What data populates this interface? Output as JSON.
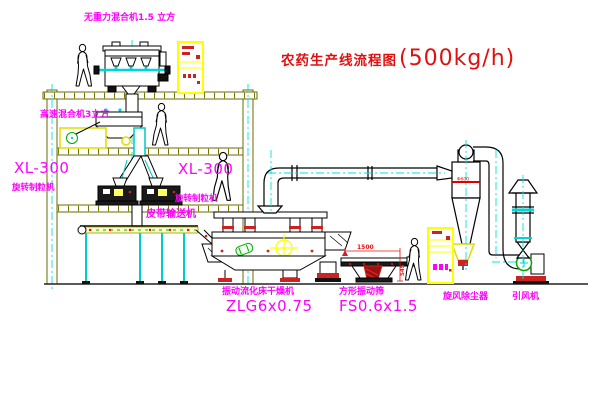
{
  "title": {
    "name": "农药生产线流程图",
    "capacity": "(500kg/h)"
  },
  "equipment_labels": {
    "gravity_mixer": "无重力混合机1.5 立方",
    "high_speed_mixer": "高速混合机3立方",
    "granulator_left": {
      "model": "XL-300",
      "name": "旋转制粒机"
    },
    "granulator_right": {
      "model": "XL-300",
      "name": "旋转制粒机"
    },
    "belt_conveyor": "皮带输送机",
    "fluid_bed_dryer": {
      "name": "振动流化床干燥机",
      "model": "ZLG6x0.75"
    },
    "vibrating_sieve": {
      "name": "方形振动筛",
      "model": "FS0.6x1.5"
    },
    "cyclone": "旋风除尘器",
    "fan": "引风机"
  },
  "dimensions": {
    "sieve_length": "1500",
    "sieve_height": "545",
    "cyclone_marking": "Φ600"
  },
  "colors": {
    "label_magenta": "#ff00ff",
    "title_red": "#e01010",
    "structure_olive": "#6b6b00",
    "centerline_cyan": "#00e0e0",
    "cabinet_yellow": "#ffff00",
    "accent_red": "#cc2222",
    "machine_green": "#00aa00",
    "background": "#ffffff"
  }
}
